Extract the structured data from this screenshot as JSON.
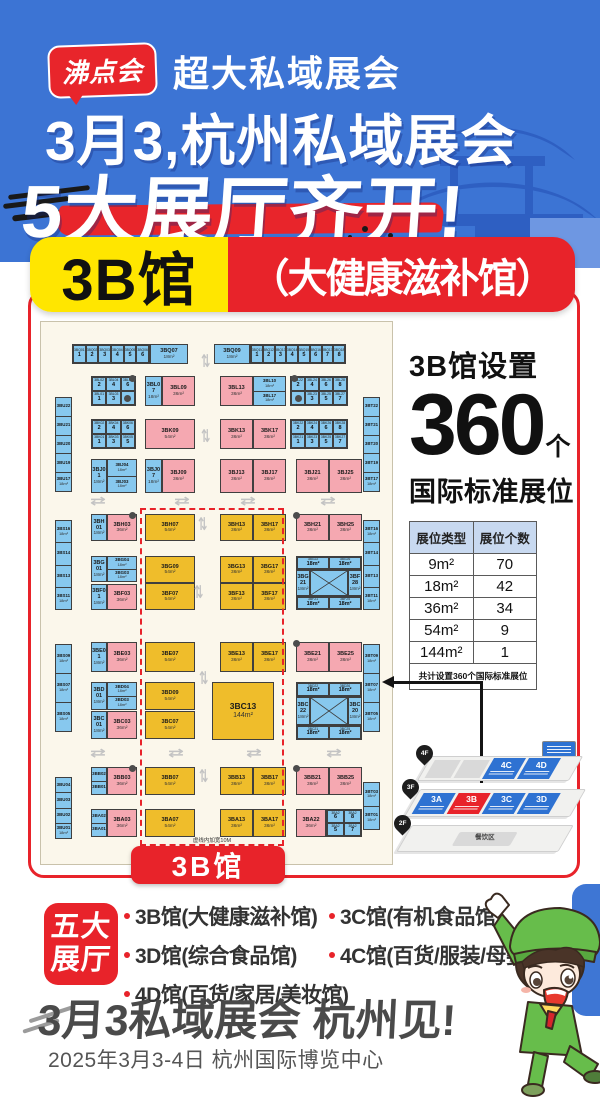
{
  "header": {
    "logo": "沸点会",
    "tagline": "超大私域展会",
    "title1": "3月3,杭州私域展会",
    "title2": "5大展厅齐开!"
  },
  "hall_badge": {
    "name": "3B馆",
    "subtitle": "（大健康滋补馆）"
  },
  "floorplan": {
    "hall_label": "3B馆",
    "note": "虚线内加宽10M",
    "items": [
      {
        "t": "grid",
        "x": 31,
        "y": 22,
        "w": 78,
        "h": 20,
        "cols": 6,
        "cells": [
          "3BQ01|1",
          "3BQ02|2",
          "3BQ03|3",
          "3BQ04|4",
          "3BQ05|5",
          "3BQ06|6"
        ]
      },
      {
        "t": "box",
        "c": "blue",
        "x": 109,
        "y": 22,
        "w": 38,
        "h": 20,
        "l": "3BQ07",
        "s": "18m²"
      },
      {
        "t": "box",
        "c": "blue",
        "x": 173,
        "y": 22,
        "w": 36,
        "h": 20,
        "l": "3BQ09",
        "s": "18m²"
      },
      {
        "t": "grid",
        "x": 209,
        "y": 22,
        "w": 96,
        "h": 20,
        "cols": 8,
        "cells": [
          "3BQ11|1",
          "3BQ12|2",
          "3BQ13|3",
          "3BQ14|4",
          "3BQ15|5",
          "3BQ16|6",
          "3BQ17|7",
          "3BQ18|8"
        ]
      },
      {
        "t": "vstrip",
        "x": 14,
        "y": 75,
        "w": 17,
        "h": 95,
        "cells": [
          "3BU22",
          "3BU21",
          "3BU20",
          "3BU19",
          "3BU17|18m²"
        ]
      },
      {
        "t": "vstrip",
        "x": 322,
        "y": 75,
        "w": 17,
        "h": 95,
        "cells": [
          "3BT22",
          "3BT21",
          "3BT20",
          "3BT19",
          "3BT17|18m²"
        ]
      },
      {
        "t": "grid",
        "x": 50,
        "y": 54,
        "w": 45,
        "h": 30,
        "cols": 3,
        "cells": [
          "3BL02|2",
          "3BL04|4",
          "3BL06|6",
          "3BL01|1",
          "3BL03|3",
          "●"
        ]
      },
      {
        "t": "box",
        "c": "blue",
        "x": 104,
        "y": 54,
        "w": 17,
        "h": 30,
        "l": "3BL07",
        "s": "18m²"
      },
      {
        "t": "box",
        "c": "pink",
        "x": 121,
        "y": 54,
        "w": 33,
        "h": 30,
        "l": "3BL09",
        "s": "36m²"
      },
      {
        "t": "box",
        "c": "pink",
        "x": 179,
        "y": 54,
        "w": 33,
        "h": 30,
        "l": "3BL13",
        "s": "36m²"
      },
      {
        "t": "stack",
        "x": 212,
        "y": 54,
        "w": 33,
        "h": 30,
        "cells": [
          "3BL10|18m²",
          "3BL17|18m²"
        ]
      },
      {
        "t": "grid",
        "x": 249,
        "y": 54,
        "w": 58,
        "h": 30,
        "cols": 4,
        "cells": [
          "3BL22|2",
          "3BL24|4",
          "3BL26|6",
          "3BL28|8",
          "●",
          "3BL23|3",
          "3BL25|5",
          "3BL27|7"
        ]
      },
      {
        "t": "grid",
        "x": 50,
        "y": 97,
        "w": 45,
        "h": 30,
        "cols": 3,
        "cells": [
          "3BK02|2",
          "3BK04|4",
          "3BK06|6",
          "3BK01|1",
          "3BK03|3",
          "3BK05|5"
        ]
      },
      {
        "t": "box",
        "c": "pink",
        "x": 104,
        "y": 97,
        "w": 50,
        "h": 30,
        "l": "3BK09",
        "s": "54m²"
      },
      {
        "t": "box",
        "c": "pink",
        "x": 179,
        "y": 97,
        "w": 33,
        "h": 30,
        "l": "3BK13",
        "s": "36m²"
      },
      {
        "t": "box",
        "c": "pink",
        "x": 212,
        "y": 97,
        "w": 33,
        "h": 30,
        "l": "3BK17",
        "s": "36m²"
      },
      {
        "t": "grid",
        "x": 249,
        "y": 97,
        "w": 58,
        "h": 30,
        "cols": 4,
        "cells": [
          "3BK22|2",
          "3BK24|4",
          "3BK26|6",
          "3BK28|8",
          "3BK21|1",
          "3BK23|3",
          "3BK25|5",
          "3BK27|7"
        ]
      },
      {
        "t": "box",
        "c": "blue",
        "x": 50,
        "y": 137,
        "w": 16,
        "h": 34,
        "l": "3BJ01",
        "s": "18m²"
      },
      {
        "t": "stack",
        "x": 66,
        "y": 137,
        "w": 30,
        "h": 34,
        "cells": [
          "3BJ04|18m²",
          "3BJ03|18m²"
        ]
      },
      {
        "t": "box",
        "c": "blue",
        "x": 104,
        "y": 137,
        "w": 17,
        "h": 34,
        "l": "3BJ07",
        "s": "18m²"
      },
      {
        "t": "box",
        "c": "pink",
        "x": 121,
        "y": 137,
        "w": 33,
        "h": 34,
        "l": "3BJ09",
        "s": "36m²"
      },
      {
        "t": "box",
        "c": "pink",
        "x": 179,
        "y": 137,
        "w": 33,
        "h": 34,
        "l": "3BJ13",
        "s": "36m²"
      },
      {
        "t": "box",
        "c": "pink",
        "x": 212,
        "y": 137,
        "w": 33,
        "h": 34,
        "l": "3BJ17",
        "s": "36m²"
      },
      {
        "t": "box",
        "c": "pink",
        "x": 255,
        "y": 137,
        "w": 33,
        "h": 34,
        "l": "3BJ21",
        "s": "36m²"
      },
      {
        "t": "box",
        "c": "pink",
        "x": 288,
        "y": 137,
        "w": 33,
        "h": 34,
        "l": "3BJ25",
        "s": "36m²"
      },
      {
        "t": "vstrip",
        "x": 14,
        "y": 198,
        "w": 17,
        "h": 90,
        "cells": [
          "3BS16|18m²",
          "3BS14",
          "3BS13",
          "3BS11|18m²"
        ]
      },
      {
        "t": "vstrip",
        "x": 322,
        "y": 198,
        "w": 17,
        "h": 90,
        "cells": [
          "3BT16|18m²",
          "3BT14",
          "3BT13",
          "3BT11|18m²"
        ]
      },
      {
        "t": "vstrip",
        "x": 14,
        "y": 322,
        "w": 17,
        "h": 88,
        "cells": [
          "3BS09|18m²",
          "3BS07|18m²",
          "3BS05|18m²"
        ]
      },
      {
        "t": "vstrip",
        "x": 322,
        "y": 322,
        "w": 17,
        "h": 88,
        "cells": [
          "3BT09|18m²",
          "3BT07|18m²",
          "3BT05|18m²"
        ]
      },
      {
        "t": "vstrip",
        "x": 14,
        "y": 455,
        "w": 17,
        "h": 62,
        "cells": [
          "3BU04",
          "3BU03",
          "3BU02",
          "3BU01|18m²"
        ]
      },
      {
        "t": "vstrip",
        "x": 322,
        "y": 460,
        "w": 17,
        "h": 48,
        "cells": [
          "3BT03|18m²",
          "3BT01|18m²"
        ]
      },
      {
        "t": "box",
        "c": "blue",
        "x": 50,
        "y": 192,
        "w": 16,
        "h": 27,
        "l": "3BH01",
        "s": "18m²"
      },
      {
        "t": "box",
        "c": "pink",
        "x": 66,
        "y": 192,
        "w": 30,
        "h": 27,
        "l": "3BH03",
        "s": "36m²"
      },
      {
        "t": "box",
        "c": "yellow",
        "x": 104,
        "y": 192,
        "w": 50,
        "h": 27,
        "l": "3BH07",
        "s": "54m²"
      },
      {
        "t": "box",
        "c": "yellow",
        "x": 179,
        "y": 192,
        "w": 33,
        "h": 27,
        "l": "3BH13",
        "s": "36m²"
      },
      {
        "t": "box",
        "c": "yellow",
        "x": 212,
        "y": 192,
        "w": 33,
        "h": 27,
        "l": "3BH17",
        "s": "36m²"
      },
      {
        "t": "box",
        "c": "pink",
        "x": 255,
        "y": 192,
        "w": 33,
        "h": 27,
        "l": "3BH21",
        "s": "36m²"
      },
      {
        "t": "box",
        "c": "pink",
        "x": 288,
        "y": 192,
        "w": 33,
        "h": 27,
        "l": "3BH25",
        "s": "36m²"
      },
      {
        "t": "box",
        "c": "blue",
        "x": 50,
        "y": 234,
        "w": 16,
        "h": 26,
        "l": "3BG01",
        "s": "18m²"
      },
      {
        "t": "stack",
        "x": 66,
        "y": 234,
        "w": 30,
        "h": 26,
        "cells": [
          "3BG04|18m²",
          "3BG03|18m²"
        ]
      },
      {
        "t": "box",
        "c": "yellow",
        "x": 104,
        "y": 234,
        "w": 50,
        "h": 27,
        "l": "3BG09",
        "s": "54m²"
      },
      {
        "t": "box",
        "c": "yellow",
        "x": 179,
        "y": 234,
        "w": 33,
        "h": 27,
        "l": "3BG13",
        "s": "36m²"
      },
      {
        "t": "box",
        "c": "yellow",
        "x": 212,
        "y": 234,
        "w": 33,
        "h": 27,
        "l": "3BG17",
        "s": "36m²"
      },
      {
        "t": "grid",
        "x": 255,
        "y": 234,
        "w": 66,
        "h": 14,
        "cols": 2,
        "cells": [
          "3BG22|18m²",
          "3BG26|18m²"
        ]
      },
      {
        "t": "box",
        "c": "blue",
        "x": 255,
        "y": 248,
        "w": 14,
        "h": 26,
        "l": "3BG21",
        "s": "18m²"
      },
      {
        "t": "xbox",
        "x": 269,
        "y": 248,
        "w": 38,
        "h": 26
      },
      {
        "t": "box",
        "c": "blue",
        "x": 307,
        "y": 248,
        "w": 14,
        "h": 26,
        "l": "3BF28",
        "s": "18m²"
      },
      {
        "t": "grid",
        "x": 255,
        "y": 274,
        "w": 66,
        "h": 14,
        "cols": 2,
        "cells": [
          "3BF21|18m²",
          "3BF25|18m²"
        ]
      },
      {
        "t": "box",
        "c": "blue",
        "x": 50,
        "y": 262,
        "w": 16,
        "h": 26,
        "l": "3BF01",
        "s": "18m²"
      },
      {
        "t": "box",
        "c": "pink",
        "x": 66,
        "y": 262,
        "w": 30,
        "h": 26,
        "l": "3BF03",
        "s": "36m²"
      },
      {
        "t": "box",
        "c": "yellow",
        "x": 104,
        "y": 261,
        "w": 50,
        "h": 27,
        "l": "3BF07",
        "s": "54m²"
      },
      {
        "t": "box",
        "c": "yellow",
        "x": 179,
        "y": 261,
        "w": 33,
        "h": 27,
        "l": "3BF13",
        "s": "36m²"
      },
      {
        "t": "box",
        "c": "yellow",
        "x": 212,
        "y": 261,
        "w": 33,
        "h": 27,
        "l": "3BF17",
        "s": "36m²"
      },
      {
        "t": "box",
        "c": "blue",
        "x": 50,
        "y": 320,
        "w": 16,
        "h": 30,
        "l": "3BE01",
        "s": "18m²"
      },
      {
        "t": "box",
        "c": "pink",
        "x": 66,
        "y": 320,
        "w": 30,
        "h": 30,
        "l": "3BE03",
        "s": "36m²"
      },
      {
        "t": "box",
        "c": "yellow",
        "x": 104,
        "y": 320,
        "w": 50,
        "h": 30,
        "l": "3BE07",
        "s": "54m²"
      },
      {
        "t": "box",
        "c": "yellow",
        "x": 179,
        "y": 320,
        "w": 33,
        "h": 30,
        "l": "3BE13",
        "s": "36m²"
      },
      {
        "t": "box",
        "c": "yellow",
        "x": 212,
        "y": 320,
        "w": 33,
        "h": 30,
        "l": "3BE17",
        "s": "36m²"
      },
      {
        "t": "box",
        "c": "pink",
        "x": 255,
        "y": 320,
        "w": 33,
        "h": 30,
        "l": "3BE21",
        "s": "36m²"
      },
      {
        "t": "box",
        "c": "pink",
        "x": 288,
        "y": 320,
        "w": 33,
        "h": 30,
        "l": "3BE25",
        "s": "36m²"
      },
      {
        "t": "box",
        "c": "blue",
        "x": 50,
        "y": 360,
        "w": 16,
        "h": 28,
        "l": "3BD01",
        "s": "18m²"
      },
      {
        "t": "stack",
        "x": 66,
        "y": 360,
        "w": 30,
        "h": 28,
        "cells": [
          "3BD04|18m²",
          "3BD03|18m²"
        ]
      },
      {
        "t": "box",
        "c": "blue",
        "x": 50,
        "y": 389,
        "w": 16,
        "h": 28,
        "l": "3BC01",
        "s": "18m²"
      },
      {
        "t": "box",
        "c": "pink",
        "x": 66,
        "y": 389,
        "w": 30,
        "h": 28,
        "l": "3BC03",
        "s": "36m²"
      },
      {
        "t": "box",
        "c": "yellow",
        "x": 104,
        "y": 360,
        "w": 50,
        "h": 28,
        "l": "3BD09",
        "s": "54m²"
      },
      {
        "t": "box",
        "c": "yellow",
        "x": 104,
        "y": 389,
        "w": 50,
        "h": 28,
        "l": "3BC07",
        "s": "54m²"
      },
      {
        "t": "big",
        "x": 171,
        "y": 360,
        "w": 62,
        "h": 58,
        "l": "3BC13",
        "s": "144m²"
      },
      {
        "t": "grid",
        "x": 255,
        "y": 360,
        "w": 66,
        "h": 15,
        "cols": 2,
        "cells": [
          "3BD22|18m²",
          "3BD26|18m²"
        ]
      },
      {
        "t": "box",
        "c": "blue",
        "x": 255,
        "y": 375,
        "w": 14,
        "h": 28,
        "l": "3BC22",
        "s": "18m²"
      },
      {
        "t": "xbox",
        "x": 269,
        "y": 375,
        "w": 38,
        "h": 28
      },
      {
        "t": "box",
        "c": "blue",
        "x": 307,
        "y": 375,
        "w": 14,
        "h": 28,
        "l": "3BC20",
        "s": "18m²"
      },
      {
        "t": "grid",
        "x": 255,
        "y": 403,
        "w": 66,
        "h": 15,
        "cols": 2,
        "cells": [
          "3BC21|18m²",
          "3BC25|18m²"
        ]
      },
      {
        "t": "stack",
        "x": 50,
        "y": 445,
        "w": 16,
        "h": 28,
        "cells": [
          "3BB02",
          "3BB01"
        ]
      },
      {
        "t": "box",
        "c": "pink",
        "x": 66,
        "y": 445,
        "w": 30,
        "h": 28,
        "l": "3BB03",
        "s": "36m²"
      },
      {
        "t": "box",
        "c": "yellow",
        "x": 104,
        "y": 445,
        "w": 50,
        "h": 28,
        "l": "3BB07",
        "s": "54m²"
      },
      {
        "t": "box",
        "c": "yellow",
        "x": 179,
        "y": 445,
        "w": 33,
        "h": 28,
        "l": "3BB13",
        "s": "36m²"
      },
      {
        "t": "box",
        "c": "yellow",
        "x": 212,
        "y": 445,
        "w": 33,
        "h": 28,
        "l": "3BB17",
        "s": "36m²"
      },
      {
        "t": "box",
        "c": "pink",
        "x": 255,
        "y": 445,
        "w": 33,
        "h": 28,
        "l": "3BB21",
        "s": "36m²"
      },
      {
        "t": "box",
        "c": "pink",
        "x": 288,
        "y": 445,
        "w": 33,
        "h": 28,
        "l": "3BB25",
        "s": "36m²"
      },
      {
        "t": "stack",
        "x": 50,
        "y": 487,
        "w": 16,
        "h": 28,
        "cells": [
          "3BA02",
          "3BA01"
        ]
      },
      {
        "t": "box",
        "c": "pink",
        "x": 66,
        "y": 487,
        "w": 30,
        "h": 28,
        "l": "3BA03",
        "s": "36m²"
      },
      {
        "t": "box",
        "c": "yellow",
        "x": 104,
        "y": 487,
        "w": 50,
        "h": 28,
        "l": "3BA07",
        "s": "54m²"
      },
      {
        "t": "box",
        "c": "yellow",
        "x": 179,
        "y": 487,
        "w": 33,
        "h": 28,
        "l": "3BA13",
        "s": "36m²"
      },
      {
        "t": "box",
        "c": "yellow",
        "x": 212,
        "y": 487,
        "w": 33,
        "h": 28,
        "l": "3BA17",
        "s": "36m²"
      },
      {
        "t": "box",
        "c": "pink",
        "x": 255,
        "y": 487,
        "w": 30,
        "h": 28,
        "l": "3BA22",
        "s": "36m²"
      },
      {
        "t": "grid",
        "x": 285,
        "y": 487,
        "w": 36,
        "h": 28,
        "cols": 2,
        "cells": [
          "3BA2|6",
          "3BA2|8",
          "3BA2|5",
          "3BA2|7"
        ]
      },
      {
        "t": "dot",
        "x": 88,
        "y": 53
      },
      {
        "t": "dot",
        "x": 250,
        "y": 53
      },
      {
        "t": "dot",
        "x": 88,
        "y": 190
      },
      {
        "t": "dot",
        "x": 252,
        "y": 190
      },
      {
        "t": "dot",
        "x": 252,
        "y": 318
      },
      {
        "t": "dot",
        "x": 88,
        "y": 443
      },
      {
        "t": "dot",
        "x": 252,
        "y": 443
      },
      {
        "t": "ah",
        "x": 52,
        "y": 172
      },
      {
        "t": "ah",
        "x": 136,
        "y": 172
      },
      {
        "t": "ah",
        "x": 202,
        "y": 172
      },
      {
        "t": "ah",
        "x": 282,
        "y": 172
      },
      {
        "t": "ah",
        "x": 52,
        "y": 424
      },
      {
        "t": "ah",
        "x": 130,
        "y": 424
      },
      {
        "t": "ah",
        "x": 208,
        "y": 424
      },
      {
        "t": "ah",
        "x": 288,
        "y": 424
      },
      {
        "t": "av",
        "x": 160,
        "y": 33
      },
      {
        "t": "av",
        "x": 160,
        "y": 108
      },
      {
        "t": "av",
        "x": 157,
        "y": 196
      },
      {
        "t": "av",
        "x": 153,
        "y": 264
      },
      {
        "t": "av",
        "x": 158,
        "y": 350
      },
      {
        "t": "av",
        "x": 158,
        "y": 448
      }
    ]
  },
  "stats": {
    "title": "3B馆设置",
    "count": "360",
    "unit": "个",
    "subtitle": "国际标准展位",
    "table": {
      "headers": [
        "展位类型",
        "展位个数"
      ],
      "rows": [
        [
          "9m²",
          "70"
        ],
        [
          "18m²",
          "42"
        ],
        [
          "36m²",
          "34"
        ],
        [
          "54m²",
          "9"
        ],
        [
          "144m²",
          "1"
        ]
      ],
      "footer": "共计设置360个国际标准展位"
    },
    "minimap": {
      "floors": [
        {
          "pin": "4F",
          "blocks": [
            {
              "label": "",
              "type": "gray"
            },
            {
              "label": "",
              "type": "gray"
            },
            {
              "label": "4C",
              "type": "blue"
            },
            {
              "label": "4D",
              "type": "blue"
            }
          ]
        },
        {
          "pin": "3F",
          "blocks": [
            {
              "label": "3A",
              "type": "blue"
            },
            {
              "label": "3B",
              "type": "red"
            },
            {
              "label": "3C",
              "type": "blue"
            },
            {
              "label": "3D",
              "type": "blue"
            }
          ]
        },
        {
          "pin": "2F",
          "blocks": [
            {
              "label": "餐饮区",
              "type": "dining"
            }
          ]
        }
      ]
    }
  },
  "footer": {
    "badge_line1": "五大",
    "badge_line2": "展厅",
    "halls": [
      "3B馆(大健康滋补馆)",
      "3C馆(有机食品馆)",
      "3D馆(综合食品馆)",
      "4C馆(百货/服装/母婴馆)",
      "4D馆(百货/家居/美妆馆)"
    ],
    "cta": "3月3私域展会 杭州见!",
    "date_venue": "2025年3月3-4日 杭州国际博览中心"
  },
  "colors": {
    "brand_blue": "#3C74D4",
    "brand_red": "#E8232A",
    "brand_yellow": "#FFE600",
    "booth_blue": "#87C8EE",
    "booth_pink": "#F5A8B1",
    "booth_yellow": "#EFBD2B"
  }
}
